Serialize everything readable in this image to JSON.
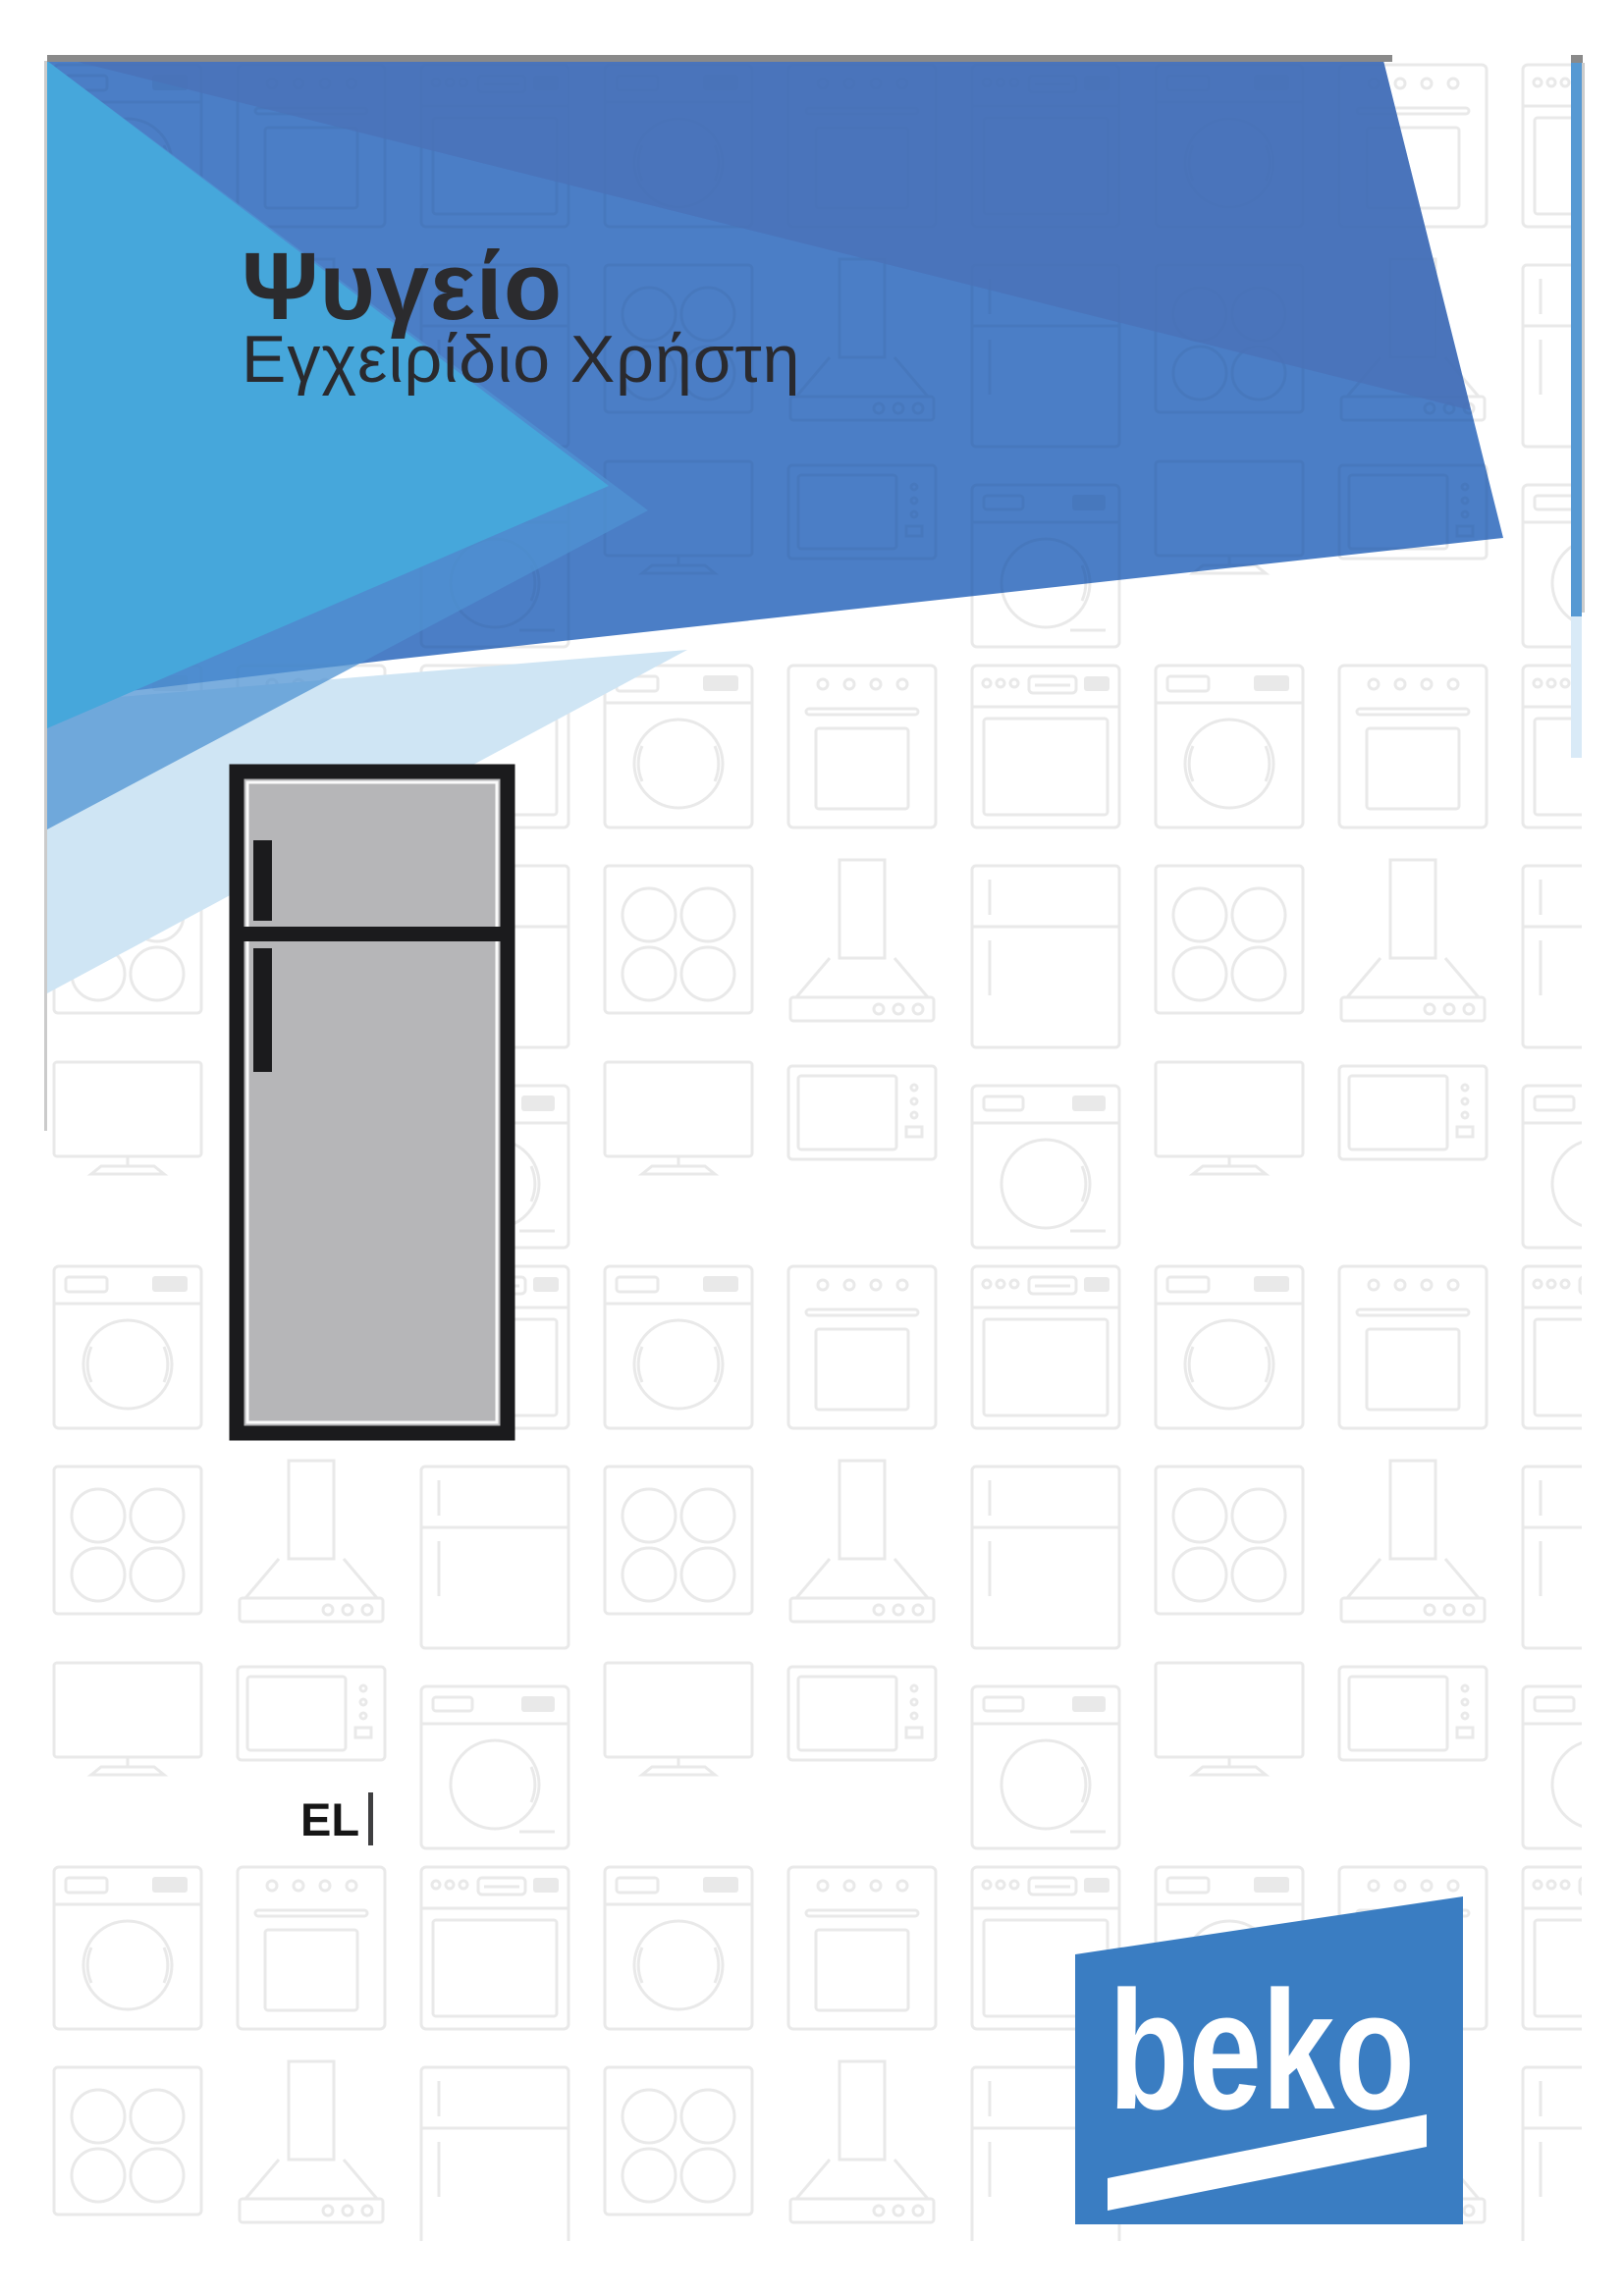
{
  "cover": {
    "title": "Ψυγείο",
    "subtitle": "Εγχειρίδιο Χρήστη",
    "language_code": "EL",
    "brand_logo_text": "beko"
  },
  "illustration": {
    "name": "top-freezer-refrigerator"
  },
  "colors": {
    "medium_blue": "#4b7ec6",
    "dark_blue": "#4a72b8",
    "cyan_blue": "#46a7db",
    "pale_blue": "#cfe5f4",
    "strip_blue": "#5699d3",
    "strip_pale": "#d9eaf7",
    "top_line_gray": "#8a8a8a",
    "logo_blue": "#3a7dc2",
    "fridge_body": "#b6b6b8",
    "fridge_outline": "#1b1b1d",
    "pattern_line": "#e9e9e9"
  }
}
